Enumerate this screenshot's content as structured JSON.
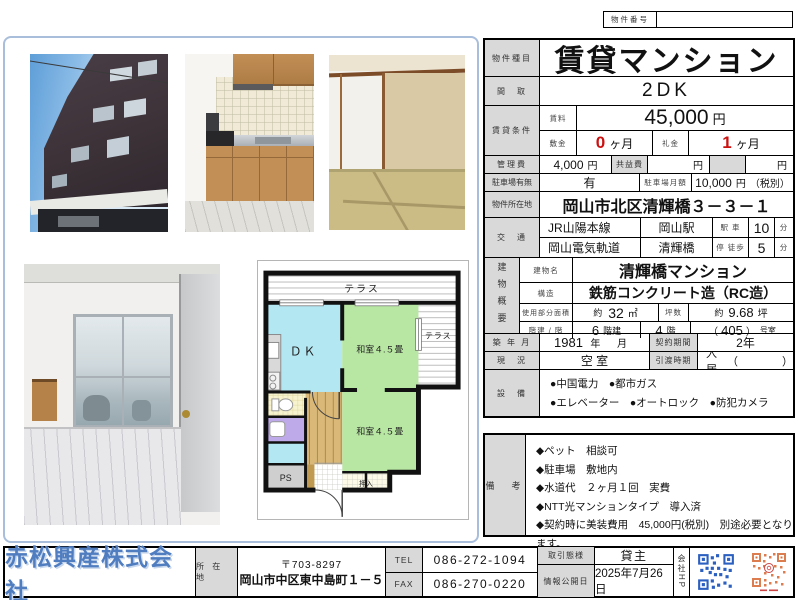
{
  "colors": {
    "accent_blue": "#4f7dc0",
    "red_value": "#cc1111",
    "label_gray": "#d9d9d9",
    "frame_blue": "#a9bedb",
    "qr_blue": "#2b5fc0",
    "qr_orange": "#d9703c"
  },
  "property_number": {
    "label": "物件番号",
    "value": ""
  },
  "listing": {
    "type_label": "物件種目",
    "type": "賃貸マンション",
    "madori_label": "間　取",
    "madori": "2DK",
    "cond_label": "賃貸条件",
    "rent_label": "賃料",
    "rent": "45,000",
    "rent_unit": "円",
    "deposit_label": "敷金",
    "deposit": "0",
    "deposit_unit": "ヶ月",
    "key_label": "礼金",
    "key": "1",
    "key_unit": "ヶ月",
    "mgmt_label": "管理費",
    "mgmt": "4,000",
    "mgmt_unit": "円",
    "kyoeki_label": "共益費",
    "kyoeki_unit": "円",
    "extra_unit": "円",
    "parking_label": "駐車場有無",
    "parking": "有",
    "parking_fee_label": "駐車場月額",
    "parking_fee": "10,000",
    "parking_fee_unit": "円",
    "parking_fee_note": "（税別）",
    "address_label": "物件所在地",
    "address": "岡山市北区清輝橋３－３－１",
    "access_label": "交　通",
    "access": [
      {
        "line": "JR山陽本線",
        "station": "岡山駅",
        "mode": "駅 車",
        "min": "10",
        "unit": "分"
      },
      {
        "line": "岡山電気軌道",
        "station": "清輝橋",
        "mode": "停 徒歩",
        "min": "5",
        "unit": "分"
      }
    ],
    "bldg_label": "建物概要",
    "bldg_name_label": "建物名",
    "bldg_name": "清輝橋マンション",
    "structure_label": "構造",
    "structure": "鉄筋コンクリート造（RC造）",
    "area_label": "使用部分面積",
    "area_approx": "約",
    "area": "32",
    "area_unit": "㎡",
    "tsubo_label": "坪数",
    "tsubo_approx": "約",
    "tsubo": "9.68",
    "tsubo_unit": "坪",
    "floors_label": "階建 / 階",
    "floors": "6",
    "floors_unit": "階建",
    "floor": "4",
    "floor_unit": "階",
    "room_open": "（",
    "room_no": "405",
    "room_close": "）",
    "room_unit": "号室",
    "built_label": "築 年 月",
    "built_year": "1981",
    "built_year_unit": "年",
    "built_month_unit": "月",
    "contract_label": "契約期間",
    "contract": "2年",
    "status_label": "現　況",
    "status": "空 室",
    "handover_label": "引渡時期",
    "handover": "即入居可",
    "handover_paren": "（　　　　）",
    "equip_label": "設　備",
    "equip_lines": [
      "●中国電力　●都市ガス",
      "●エレベーター　●オートロック　●防犯カメラ"
    ]
  },
  "remarks": {
    "label": "備　考",
    "lines": [
      "◆ペット　相談可",
      "◆駐車場　敷地内",
      "◆水道代　２ヶ月１回　実費",
      "◆NTT光マンションタイプ　導入済",
      "◆契約時に美装費用　45,000円(税別)　別途必要となります。"
    ]
  },
  "footer": {
    "company": "赤松興産株式会社",
    "addr_label": "所 在 地",
    "postal": "〒703-8297",
    "address": "岡山市中区東中島町１－５",
    "tel_label": "TEL",
    "tel": "086-272-1094",
    "fax_label": "FAX",
    "fax": "086-270-0220",
    "deal_label": "取引態様",
    "deal": "貸主",
    "date_label": "情報公開日",
    "date": "2025年7月26日",
    "hp_label": "会社HP"
  },
  "floorplan": {
    "terrace_top": "テラス",
    "terrace_right": "テラス",
    "dk": "ＤＫ",
    "room1": "和室４.５畳",
    "room2": "和室４.５畳",
    "closet": "押入",
    "ps": "PS"
  }
}
